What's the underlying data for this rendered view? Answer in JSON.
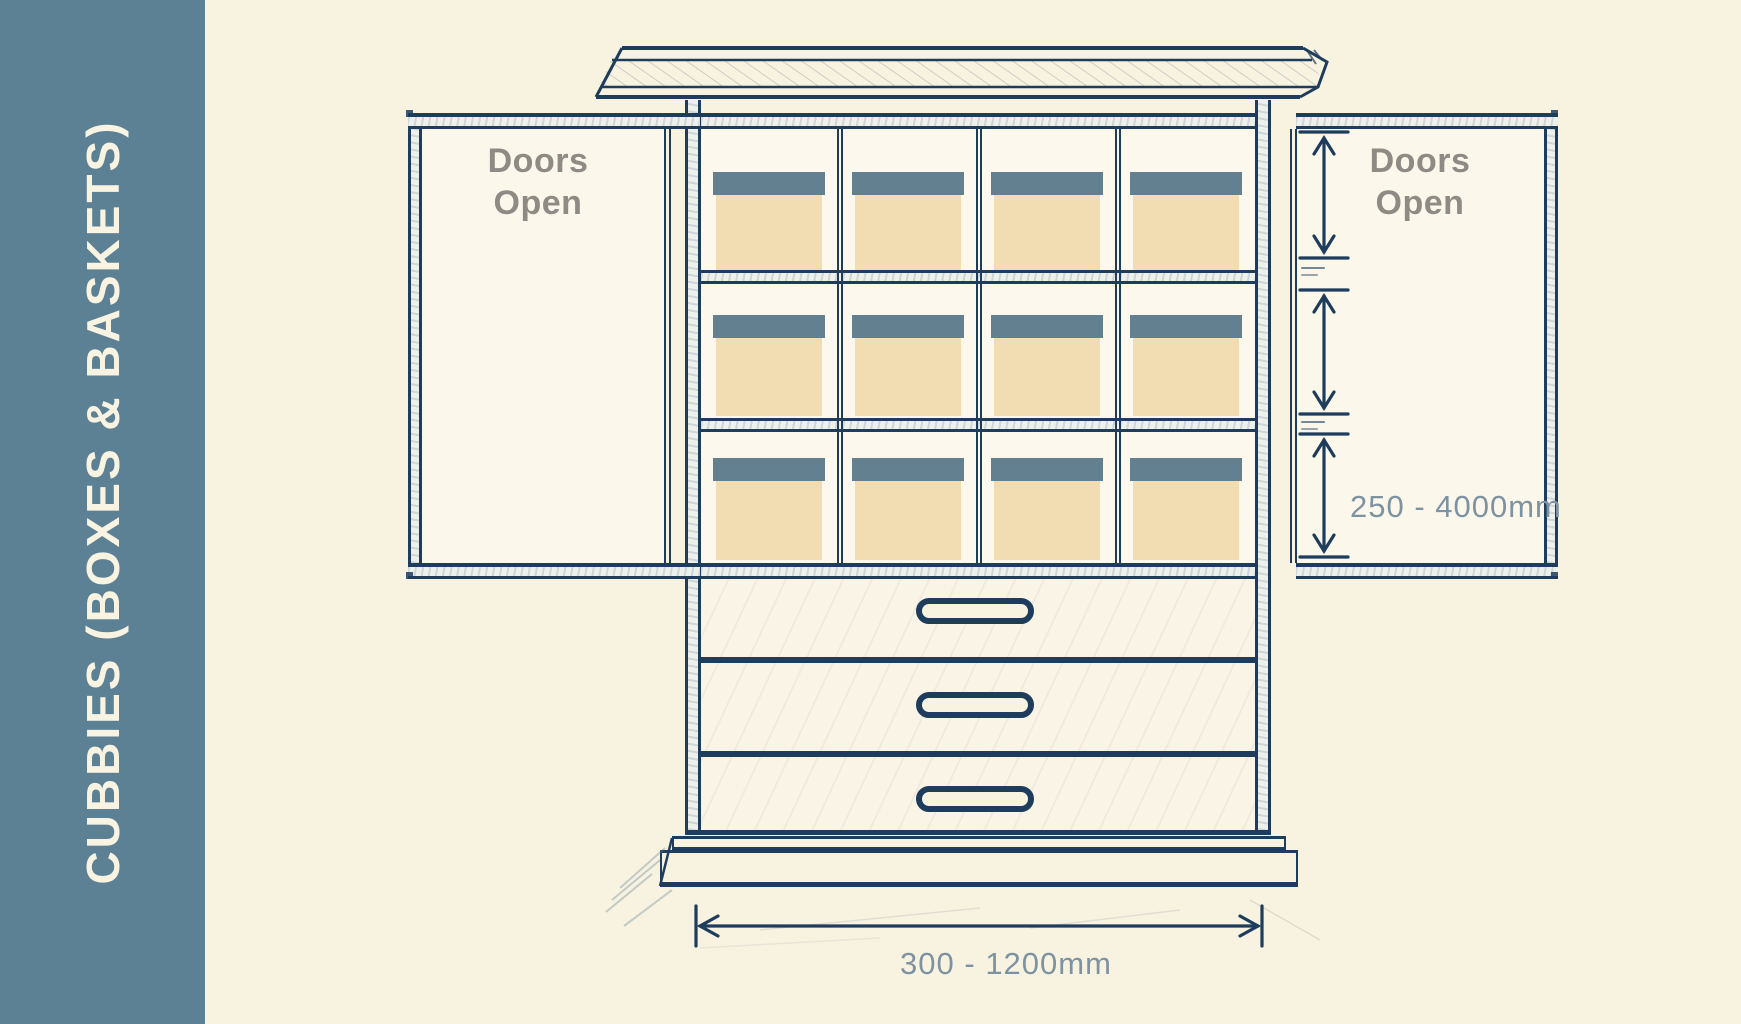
{
  "sidebar": {
    "title": "CUBBIES (BOXES & BASKETS)"
  },
  "doors": {
    "left_label_line1": "Doors",
    "left_label_line2": "Open",
    "right_label_line1": "Doors",
    "right_label_line2": "Open"
  },
  "dimensions": {
    "cubby_height_range": "250 - 4000mm",
    "cubby_width_range": "300 - 1200mm"
  },
  "cubbies": {
    "rows": 3,
    "columns": 4,
    "box_count": 12
  },
  "drawers": {
    "count": 3
  },
  "colors": {
    "sidebar_band": "#5c8195",
    "line_ink": "#1e3c5c",
    "box_body": "#f2dcb2",
    "box_lid": "#62808f",
    "background": "#f8f2e1",
    "door_label": "#8e8b85",
    "dimension_text": "#7e93a2"
  }
}
